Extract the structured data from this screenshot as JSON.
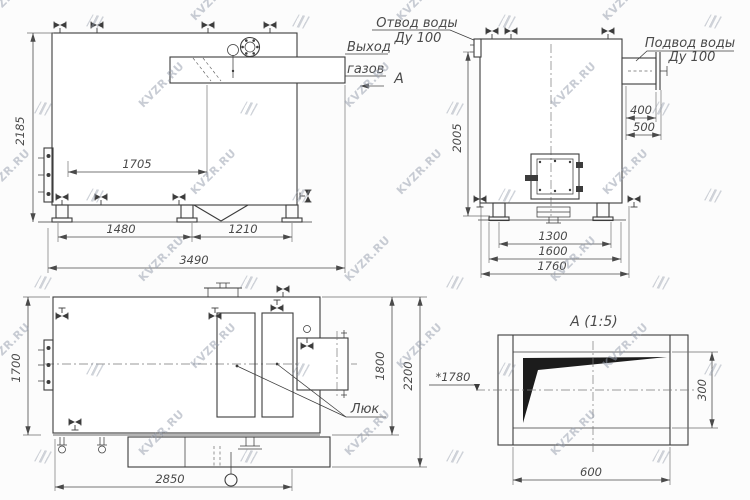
{
  "watermark": {
    "text": "KVZR.RU"
  },
  "colors": {
    "line": "#3c3c3c",
    "dim_text": "#4a4a4a",
    "watermark": "rgba(150,158,172,0.52)"
  },
  "views": {
    "front": {
      "dims": {
        "height": "2185",
        "to_duct_axis": "1705",
        "left_base": "1480",
        "right_base": "1210",
        "overall_length": "3490"
      },
      "labels": {
        "gas_outlet_1": "Выход",
        "gas_outlet_2": "газов",
        "view_letter": "А",
        "water_outlet_1": "Отвод воды",
        "water_outlet_2": "Ду 100"
      }
    },
    "side": {
      "dims": {
        "height": "2005",
        "duct_offset": "400",
        "duct_flange": "500",
        "base_width": "1300",
        "frame_width": "1600",
        "overall_width": "1760"
      },
      "labels": {
        "water_inlet_1": "Подвод воды",
        "water_inlet_2": "Ду 100"
      }
    },
    "plan": {
      "dims": {
        "width": "1700",
        "base_length": "2850",
        "body_span": "1800",
        "overall_span": "2200"
      },
      "labels": {
        "hatch": "Люк"
      }
    },
    "detail": {
      "title": "А (1:5)",
      "dims": {
        "axis_height": "*1780",
        "duct_height": "300",
        "duct_width": "600"
      }
    }
  }
}
